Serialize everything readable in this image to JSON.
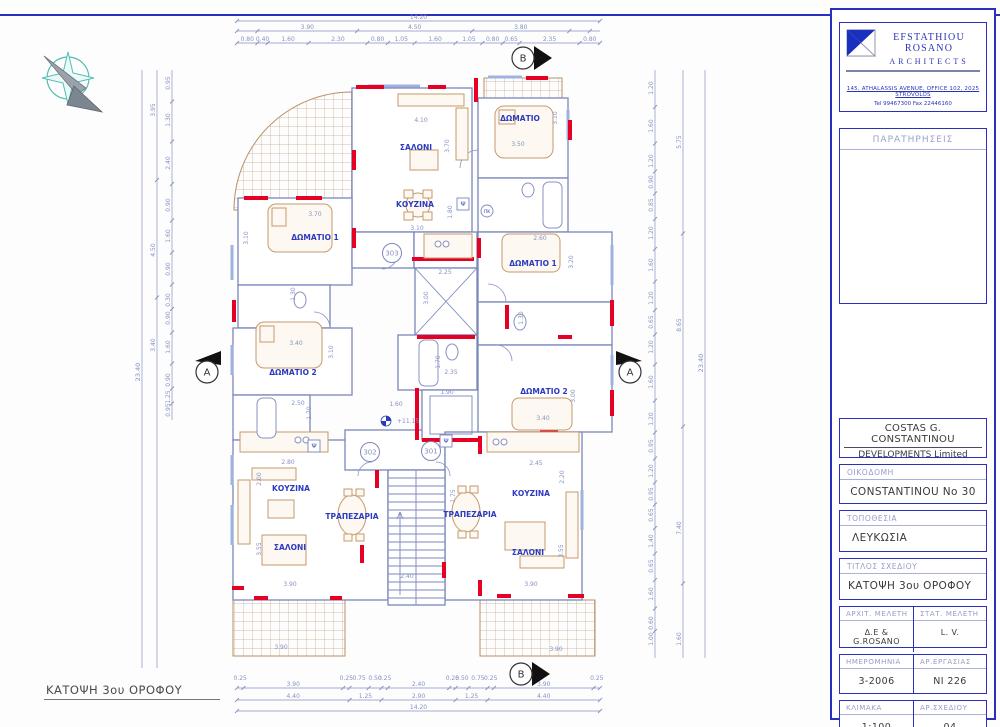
{
  "firm": {
    "name": "EFSTATHIOU ROSANO",
    "subtitle": "ARCHITECTS",
    "address": "145, ATHALASSIS AVENUE, OFFICE 102, 2025 STROVOLOS",
    "phone": "Tel 99467300   Fax 22446160"
  },
  "titleblock": {
    "remarks_label": "ΠΑΡΑΤΗΡΗΣΕΙΣ",
    "client_line1": "COSTAS G. CONSTANTINOU",
    "client_line2": "DEVELOPMENTS Limited",
    "building_label": "ΟΙΚΟΔΟΜΗ",
    "building_value": "CONSTANTINOU No 30",
    "location_label": "ΤΟΠΟΘΕΣΙΑ",
    "location_value": "ΛΕΥΚΩΣΙΑ",
    "drawing_title_label": "ΤΙΤΛΟΣ ΣΧΕΔΙΟΥ",
    "drawing_title_value": "ΚΑΤΟΨΗ 3ου ΟΡΟΦΟΥ",
    "arch_label": "ΑΡΧΙΤ. ΜΕΛΕΤΗ",
    "arch_value": "Δ.Ε & G.ROSANO",
    "struct_label": "ΣΤΑΤ. ΜΕΛΕΤΗ",
    "struct_value": "L. V.",
    "date_label": "ΗΜΕΡΟΜΗΝΙΑ",
    "date_value": "3-2006",
    "job_label": "ΑΡ.ΕΡΓΑΣΙΑΣ",
    "job_value": "NI 226",
    "scale_label": "ΚΛΙΜΑΚΑ",
    "scale_value": "1:100",
    "sheet_label": "ΑΡ.ΣΧΕΔΙΟΥ",
    "sheet_value": "04"
  },
  "plan": {
    "caption": "ΚΑΤΟΨΗ 3ου ΟΡΟΦΟΥ",
    "level": "+11.15",
    "room_labels": [
      {
        "t": "ΣΑΛΟΝΙ",
        "x": 416,
        "y": 150
      },
      {
        "t": "ΚΟΥΖΙΝΑ",
        "x": 415,
        "y": 207
      },
      {
        "t": "ΔΩΜΑΤΙΟ 1",
        "x": 315,
        "y": 240
      },
      {
        "t": "ΔΩΜΑΤΙΟ 2",
        "x": 293,
        "y": 375
      },
      {
        "t": "ΔΩΜΑΤΙΟ",
        "x": 520,
        "y": 121
      },
      {
        "t": "ΔΩΜΑΤΙΟ 1",
        "x": 533,
        "y": 266
      },
      {
        "t": "ΔΩΜΑΤΙΟ 2",
        "x": 544,
        "y": 394
      },
      {
        "t": "ΚΟΥΖΙΝΑ",
        "x": 291,
        "y": 491
      },
      {
        "t": "ΤΡΑΠΕΖΑΡΙΑ",
        "x": 352,
        "y": 519
      },
      {
        "t": "ΣΑΛΟΝΙ",
        "x": 290,
        "y": 550
      },
      {
        "t": "ΚΟΥΖΙΝΑ",
        "x": 531,
        "y": 496
      },
      {
        "t": "ΤΡΑΠΕΖΑΡΙΑ",
        "x": 470,
        "y": 517
      },
      {
        "t": "ΣΑΛΟΝΙ",
        "x": 528,
        "y": 555
      }
    ],
    "dim_labels": [
      {
        "t": "4.10",
        "x": 421,
        "y": 122
      },
      {
        "t": "3.70",
        "x": 449,
        "y": 146,
        "r": 1
      },
      {
        "t": "3.10",
        "x": 417,
        "y": 230
      },
      {
        "t": "1.80",
        "x": 452,
        "y": 212,
        "r": 1
      },
      {
        "t": "3.70",
        "x": 315,
        "y": 216
      },
      {
        "t": "3.10",
        "x": 248,
        "y": 238,
        "r": 1
      },
      {
        "t": "3.50",
        "x": 518,
        "y": 146
      },
      {
        "t": "3.10",
        "x": 557,
        "y": 118,
        "r": 1
      },
      {
        "t": "2.25",
        "x": 445,
        "y": 274
      },
      {
        "t": "3.00",
        "x": 428,
        "y": 298,
        "r": 1
      },
      {
        "t": "2.35",
        "x": 451,
        "y": 374
      },
      {
        "t": "1.70",
        "x": 440,
        "y": 362,
        "r": 1
      },
      {
        "t": "2.60",
        "x": 540,
        "y": 240
      },
      {
        "t": "3.20",
        "x": 573,
        "y": 262,
        "r": 1
      },
      {
        "t": "1.30",
        "x": 523,
        "y": 318,
        "r": 1
      },
      {
        "t": "3.40",
        "x": 543,
        "y": 420
      },
      {
        "t": "3.00",
        "x": 575,
        "y": 396,
        "r": 1
      },
      {
        "t": "3.40",
        "x": 296,
        "y": 345
      },
      {
        "t": "3.10",
        "x": 333,
        "y": 352,
        "r": 1
      },
      {
        "t": "1.30",
        "x": 295,
        "y": 294,
        "r": 1
      },
      {
        "t": "2.50",
        "x": 298,
        "y": 405
      },
      {
        "t": "1.70",
        "x": 311,
        "y": 413,
        "r": 1
      },
      {
        "t": "2.80",
        "x": 288,
        "y": 464
      },
      {
        "t": "2.00",
        "x": 261,
        "y": 479,
        "r": 1
      },
      {
        "t": "3.90",
        "x": 290,
        "y": 586
      },
      {
        "t": "3.55",
        "x": 261,
        "y": 549,
        "r": 1
      },
      {
        "t": "2.45",
        "x": 536,
        "y": 465
      },
      {
        "t": "2.20",
        "x": 564,
        "y": 477,
        "r": 1
      },
      {
        "t": "3.90",
        "x": 531,
        "y": 586
      },
      {
        "t": "3.55",
        "x": 563,
        "y": 551,
        "r": 1
      },
      {
        "t": "1.75",
        "x": 455,
        "y": 496,
        "r": 1
      },
      {
        "t": "1.90",
        "x": 447,
        "y": 394
      },
      {
        "t": "1.60",
        "x": 396,
        "y": 406
      },
      {
        "t": "2.40",
        "x": 407,
        "y": 578
      },
      {
        "t": "3.90",
        "x": 281,
        "y": 649
      },
      {
        "t": "3.90",
        "x": 556,
        "y": 651
      }
    ],
    "unit_circles": [
      {
        "t": "303",
        "x": 392,
        "y": 253
      },
      {
        "t": "302",
        "x": 370,
        "y": 452
      },
      {
        "t": "301",
        "x": 431,
        "y": 451
      }
    ],
    "small_labels": [
      {
        "t": "Ψ",
        "x": 463,
        "y": 204,
        "k": "box"
      },
      {
        "t": "Ψ",
        "x": 314,
        "y": 446,
        "k": "box"
      },
      {
        "t": "Ψ",
        "x": 446,
        "y": 441,
        "k": "box"
      },
      {
        "t": "ΠΚ",
        "x": 487,
        "y": 211,
        "k": "circle"
      }
    ],
    "section_markers": [
      {
        "label": "B",
        "x": 523,
        "y": 58,
        "dir": "right"
      },
      {
        "label": "B",
        "x": 521,
        "y": 674,
        "dir": "right"
      },
      {
        "label": "A",
        "x": 207,
        "y": 372,
        "dir": "up-right"
      },
      {
        "label": "A",
        "x": 630,
        "y": 372,
        "dir": "up-left"
      }
    ],
    "chains": {
      "top_total": "14.20",
      "top_mid": [
        "3.90",
        "4.50",
        "3.80"
      ],
      "top_inner": [
        "0.80",
        "0.40",
        "1.60",
        "2.30",
        "0.80",
        "1.05",
        "1.60",
        "1.05",
        "0.80",
        "0.65",
        "2.35",
        "0.80"
      ],
      "bottom_inner": [
        "0.25",
        "3.90",
        "0.25",
        "0.75",
        "0.50",
        "0.25",
        "2.40",
        "0.25",
        "0.50",
        "0.75",
        "0.25",
        "3.90",
        "0.25"
      ],
      "bottom_mid": [
        "4.40",
        "1.25",
        "2.90",
        "1.25",
        "4.40"
      ],
      "bottom_total": "14.20",
      "left_total": "23.40",
      "left_mid": [
        {
          "t": "3.95",
          "y": 110
        },
        {
          "t": "4.50",
          "y": 250
        },
        {
          "t": "3.40",
          "y": 345
        }
      ],
      "left_inner": [
        {
          "t": "0.95",
          "y": 83
        },
        {
          "t": "1.30",
          "y": 120
        },
        {
          "t": "2.40",
          "y": 163
        },
        {
          "t": "0.90",
          "y": 205
        },
        {
          "t": "1.60",
          "y": 236
        },
        {
          "t": "0.90",
          "y": 269
        },
        {
          "t": "0.30",
          "y": 300
        },
        {
          "t": "0.90",
          "y": 318
        },
        {
          "t": "1.60",
          "y": 347
        },
        {
          "t": "0.90",
          "y": 380
        },
        {
          "t": "1.25",
          "y": 397
        },
        {
          "t": "0.95",
          "y": 410
        }
      ],
      "right_inner": [
        {
          "t": "1.20",
          "y": 88
        },
        {
          "t": "1.60",
          "y": 126
        },
        {
          "t": "1.20",
          "y": 161
        },
        {
          "t": "0.90",
          "y": 182
        },
        {
          "t": "0.85",
          "y": 205
        },
        {
          "t": "1.20",
          "y": 233
        },
        {
          "t": "1.60",
          "y": 265
        },
        {
          "t": "1.20",
          "y": 298
        },
        {
          "t": "0.65",
          "y": 322
        },
        {
          "t": "1.20",
          "y": 347
        },
        {
          "t": "1.60",
          "y": 382
        },
        {
          "t": "1.20",
          "y": 419
        },
        {
          "t": "0.95",
          "y": 446
        },
        {
          "t": "1.20",
          "y": 471
        },
        {
          "t": "0.95",
          "y": 494
        },
        {
          "t": "0.65",
          "y": 515
        },
        {
          "t": "1.40",
          "y": 541
        },
        {
          "t": "0.65",
          "y": 566
        },
        {
          "t": "1.60",
          "y": 594
        },
        {
          "t": "0.60",
          "y": 623
        },
        {
          "t": "1.00",
          "y": 639
        }
      ],
      "right_groups": [
        {
          "t": "5.75",
          "y": 142
        },
        {
          "t": "8.65",
          "y": 325
        },
        {
          "t": "7.40",
          "y": 528
        },
        {
          "t": "1.60",
          "y": 639
        }
      ],
      "right_total": "23.40"
    }
  },
  "colors": {
    "frame": "#2a2fbf",
    "wall": "#7b87bb",
    "red": "#e60023",
    "label": "#2b3bbf",
    "dim": "#8691c2",
    "furniture": "#c49a6c",
    "tile": "#c8a488",
    "teal": "#53bdb4"
  }
}
